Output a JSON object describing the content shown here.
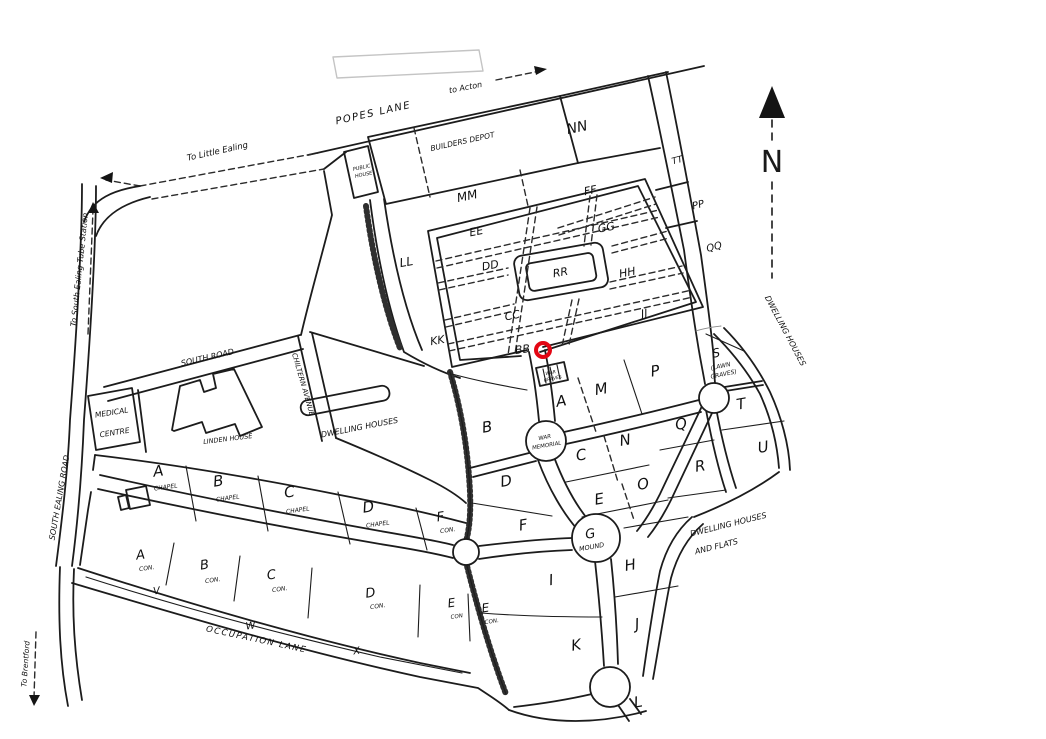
{
  "compass": {
    "north": "N"
  },
  "marker": {
    "color": "#e30613",
    "section": "BB"
  },
  "roads": {
    "popes_lane": "POPES LANE",
    "south_road": "SOUTH ROAD",
    "chiltern_avenue": "CHILTERN AVENUE",
    "south_ealing_road": "SOUTH EALING ROAD",
    "occupation_lane": "OCCUPATION LANE"
  },
  "directions": {
    "to_acton": "to Acton",
    "to_little_ealing": "To Little Ealing",
    "to_south_ealing_tube": "To South Ealing Tube Station",
    "to_brentford": "To Brentford"
  },
  "places": {
    "builders_depot": "BUILDERS DEPOT",
    "public_house_line1": "PUBLIC",
    "public_house_line2": "HOUSE",
    "medical_centre_line1": "MEDICAL",
    "medical_centre_line2": "CENTRE",
    "linden_house": "LINDEN HOUSE",
    "dwelling_houses_west": "DWELLING HOUSES",
    "dwelling_houses_east": "DWELLING HOUSES",
    "dwelling_flats_line1": "DWELLING HOUSES",
    "dwelling_flats_line2": "AND FLATS",
    "war_graves_line1": "WAR",
    "war_graves_line2": "GRAVES",
    "war_memorial_line1": "WAR",
    "war_memorial_line2": "MEMORIAL"
  },
  "old_ground": {
    "bb": "BB",
    "cc": "CC",
    "dd": "DD",
    "ee": "EE",
    "ff": "FF",
    "gg": "GG",
    "hh": "HH",
    "jj": "JJ",
    "kk": "KK",
    "ll": "LL",
    "mm": "MM",
    "nn": "NN",
    "pp": "PP",
    "qq": "QQ",
    "rr": "RR",
    "tt": "TT"
  },
  "sections": {
    "a": "A",
    "b": "B",
    "c": "C",
    "d": "D",
    "e": "E",
    "f": "F",
    "g": "G",
    "g_sub": "MOUND",
    "h": "H",
    "i": "I",
    "j": "J",
    "k": "K",
    "l": "L",
    "m": "M",
    "n": "N",
    "o": "O",
    "p": "P",
    "q": "Q",
    "r": "R",
    "s": "S",
    "s_sub1": "(LAWN",
    "s_sub2": "GRAVES)",
    "t": "T",
    "u": "U"
  },
  "chapel_row": {
    "a": "A",
    "a_sub": "CHAPEL",
    "b": "B",
    "b_sub": "CHAPEL",
    "c": "C",
    "c_sub": "CHAPEL",
    "d": "D",
    "d_sub": "CHAPEL",
    "f": "F",
    "f_sub": "CON."
  },
  "con_row": {
    "a": "A",
    "a_sub": "CON.",
    "b": "B",
    "b_sub": "CON.",
    "c": "C",
    "c_sub": "CON.",
    "d": "D",
    "d_sub": "CON.",
    "e1": "E",
    "e1_sub": "CON",
    "e2": "E",
    "e2_sub": "CON.",
    "v": "V",
    "w": "W",
    "x": "X"
  }
}
